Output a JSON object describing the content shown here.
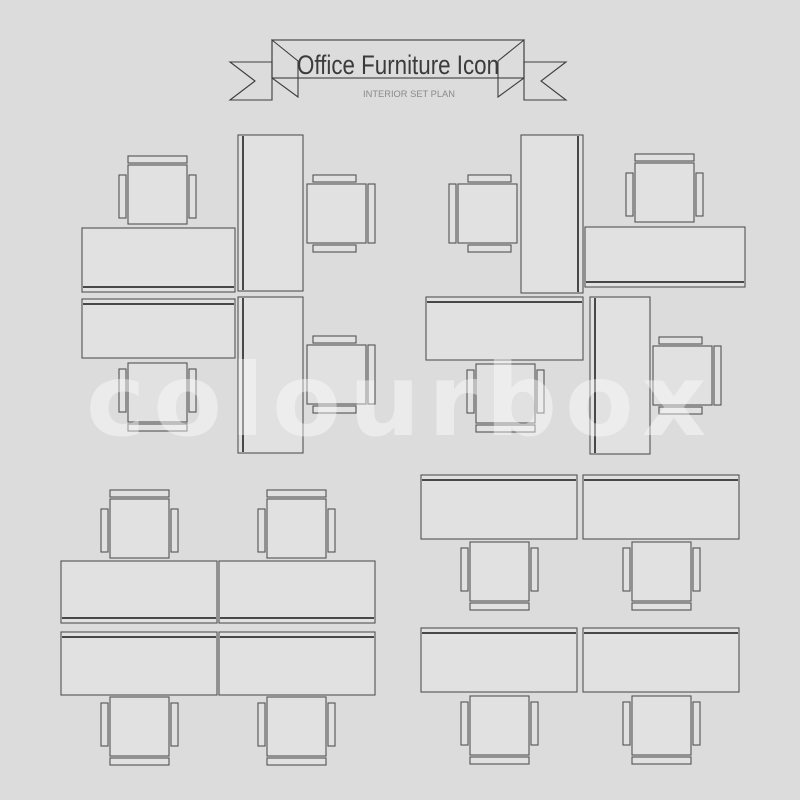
{
  "banner": {
    "title": "Office Furniture Icon",
    "subtitle": "INTERIOR SET PLAN"
  },
  "watermark": {
    "text": "colourbox"
  },
  "colors": {
    "background": "#dcdcdc",
    "furniture_fill": "#e1e1e1",
    "furniture_line": "#535353",
    "screen_line": "#484848",
    "ribbon_line": "#3e3e3e",
    "title_text": "#3b3b3b",
    "subtitle_text": "#8a8a8a",
    "watermark": "rgba(255,255,255,0.42)"
  },
  "furniture": {
    "chair": {
      "seat": 59,
      "bar_thickness": 7,
      "back_gap": 2,
      "arm_gap": 2,
      "arm_length": 43,
      "arm_offset": 10
    },
    "screen_inset": 5,
    "groups": [
      {
        "name": "top-left-pinwheel",
        "desks": [
          [
            82,
            228,
            153,
            64,
            "bottom"
          ],
          [
            238,
            135,
            65,
            156,
            "left"
          ],
          [
            82,
            299,
            153,
            59,
            "top"
          ],
          [
            238,
            297,
            65,
            156,
            "left"
          ]
        ],
        "chairs": [
          [
            128,
            165,
            "top"
          ],
          [
            307,
            184,
            "right"
          ],
          [
            128,
            363,
            "bottom"
          ],
          [
            307,
            345,
            "right"
          ]
        ]
      },
      {
        "name": "top-right-pinwheel",
        "desks": [
          [
            521,
            135,
            62,
            158,
            "right"
          ],
          [
            585,
            227,
            160,
            60,
            "bottom"
          ],
          [
            426,
            297,
            157,
            63,
            "top"
          ],
          [
            590,
            297,
            60,
            157,
            "left"
          ]
        ],
        "chairs": [
          [
            458,
            184,
            "left"
          ],
          [
            635,
            163,
            "top"
          ],
          [
            476,
            364,
            "bottom"
          ],
          [
            653,
            346,
            "right"
          ]
        ]
      },
      {
        "name": "bottom-left-grid",
        "desks": [
          [
            61,
            561,
            156,
            62,
            "bottom"
          ],
          [
            219,
            561,
            156,
            62,
            "bottom"
          ],
          [
            61,
            632,
            156,
            63,
            "top"
          ],
          [
            219,
            632,
            156,
            63,
            "top"
          ]
        ],
        "chairs": [
          [
            110,
            499,
            "top"
          ],
          [
            267,
            499,
            "top"
          ],
          [
            110,
            697,
            "bottom"
          ],
          [
            267,
            697,
            "bottom"
          ]
        ]
      },
      {
        "name": "bottom-right-grid",
        "desks": [
          [
            421,
            475,
            156,
            64,
            "top"
          ],
          [
            583,
            475,
            156,
            64,
            "top"
          ],
          [
            421,
            628,
            156,
            64,
            "top"
          ],
          [
            583,
            628,
            156,
            64,
            "top"
          ]
        ],
        "chairs": [
          [
            470,
            542,
            "bottom"
          ],
          [
            632,
            542,
            "bottom"
          ],
          [
            470,
            696,
            "bottom"
          ],
          [
            632,
            696,
            "bottom"
          ]
        ]
      }
    ]
  }
}
